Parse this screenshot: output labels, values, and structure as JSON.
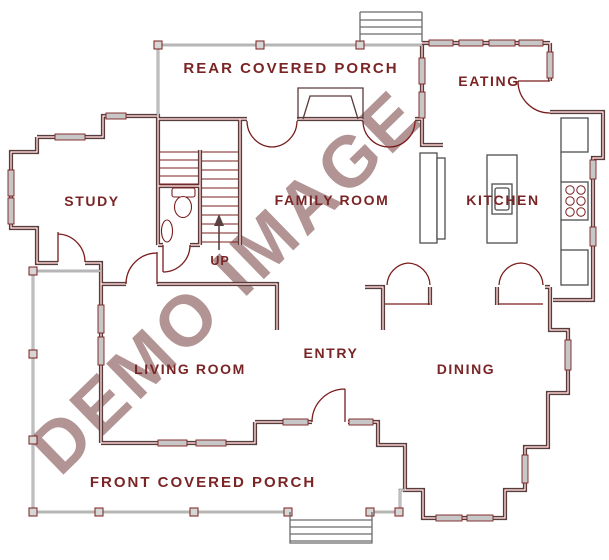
{
  "watermark": {
    "text": "DEMO IMAGE",
    "color": "#b29494"
  },
  "colors": {
    "wall_outer_gray": "#4a4a4a",
    "wall_inner_red": "#7b1d1d",
    "label_red": "#7b2425",
    "window_fill": "#c7c7c7",
    "railing_gray": "#6e6e6e"
  },
  "rooms": [
    {
      "id": "rear-covered-porch",
      "label": "REAR COVERED PORCH"
    },
    {
      "id": "eating",
      "label": "EATING"
    },
    {
      "id": "study",
      "label": "STUDY"
    },
    {
      "id": "family-room",
      "label": "FAMILY ROOM"
    },
    {
      "id": "kitchen",
      "label": "KITCHEN"
    },
    {
      "id": "living-room",
      "label": "LIVING ROOM"
    },
    {
      "id": "entry",
      "label": "ENTRY"
    },
    {
      "id": "dining",
      "label": "DINING"
    },
    {
      "id": "front-covered-porch",
      "label": "FRONT COVERED PORCH"
    }
  ],
  "stairs": {
    "direction_label": "UP"
  }
}
